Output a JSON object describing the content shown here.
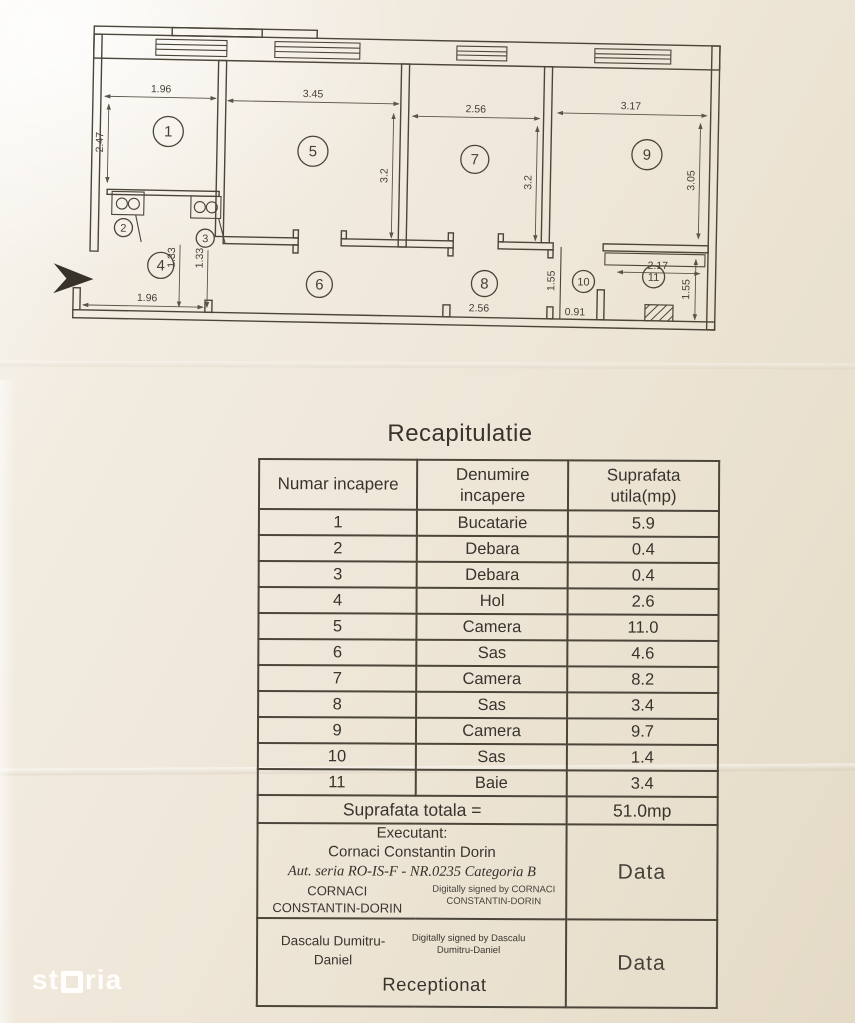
{
  "floor_plan": {
    "room_numbers": [
      "1",
      "2",
      "3",
      "4",
      "5",
      "6",
      "7",
      "8",
      "9",
      "10",
      "11"
    ],
    "dimensions": {
      "room1_width": "1.96",
      "room1_height": "2.47",
      "room5_width": "3.45",
      "room5_height": "3.2",
      "room7_width": "2.56",
      "room7_height": "3.2",
      "room9_width": "3.17",
      "room9_height": "3.05",
      "hall_left": "1.33",
      "hall_right": "1.33",
      "bottom_left": "1.96",
      "bottom_center": "2.56",
      "sas10_width": "0.91",
      "sas10_height": "1.55",
      "room11_width": "2.17",
      "room11_height": "1.55"
    }
  },
  "recap": {
    "title": "Recapitulatie",
    "columns": [
      "Numar incapere",
      "Denumire incapere",
      "Suprafata utila(mp)"
    ],
    "rows": [
      {
        "nr": "1",
        "name": "Bucatarie",
        "area": "5.9"
      },
      {
        "nr": "2",
        "name": "Debara",
        "area": "0.4"
      },
      {
        "nr": "3",
        "name": "Debara",
        "area": "0.4"
      },
      {
        "nr": "4",
        "name": "Hol",
        "area": "2.6"
      },
      {
        "nr": "5",
        "name": "Camera",
        "area": "11.0"
      },
      {
        "nr": "6",
        "name": "Sas",
        "area": "4.6"
      },
      {
        "nr": "7",
        "name": "Camera",
        "area": "8.2"
      },
      {
        "nr": "8",
        "name": "Sas",
        "area": "3.4"
      },
      {
        "nr": "9",
        "name": "Camera",
        "area": "9.7"
      },
      {
        "nr": "10",
        "name": "Sas",
        "area": "1.4"
      },
      {
        "nr": "11",
        "name": "Baie",
        "area": "3.4"
      }
    ],
    "total_label": "Suprafata totala =",
    "total_value": "51.0mp"
  },
  "signatures": {
    "executant": {
      "label": "Executant:",
      "name": "Cornaci Constantin Dorin",
      "authorization": "Aut. seria RO-IS-F - NR.0235 Categoria B",
      "signer_name": "CORNACI CONSTANTIN-DORIN",
      "signature_note": "Digitally signed by CORNACI CONSTANTIN-DORIN",
      "date_label": "Data"
    },
    "receptionat": {
      "signer_name": "Dascalu Dumitru-Daniel",
      "signature_note": "Digitally signed by Dascalu Dumitru-Daniel",
      "label": "Receptionat",
      "date_label": "Data"
    }
  },
  "watermark": {
    "brand": "storia",
    "brand_prefix": "st",
    "brand_suffix": "ria"
  },
  "colors": {
    "paper": "#efe7d9",
    "ink": "#4b4539",
    "watermark": "#ffffff"
  }
}
